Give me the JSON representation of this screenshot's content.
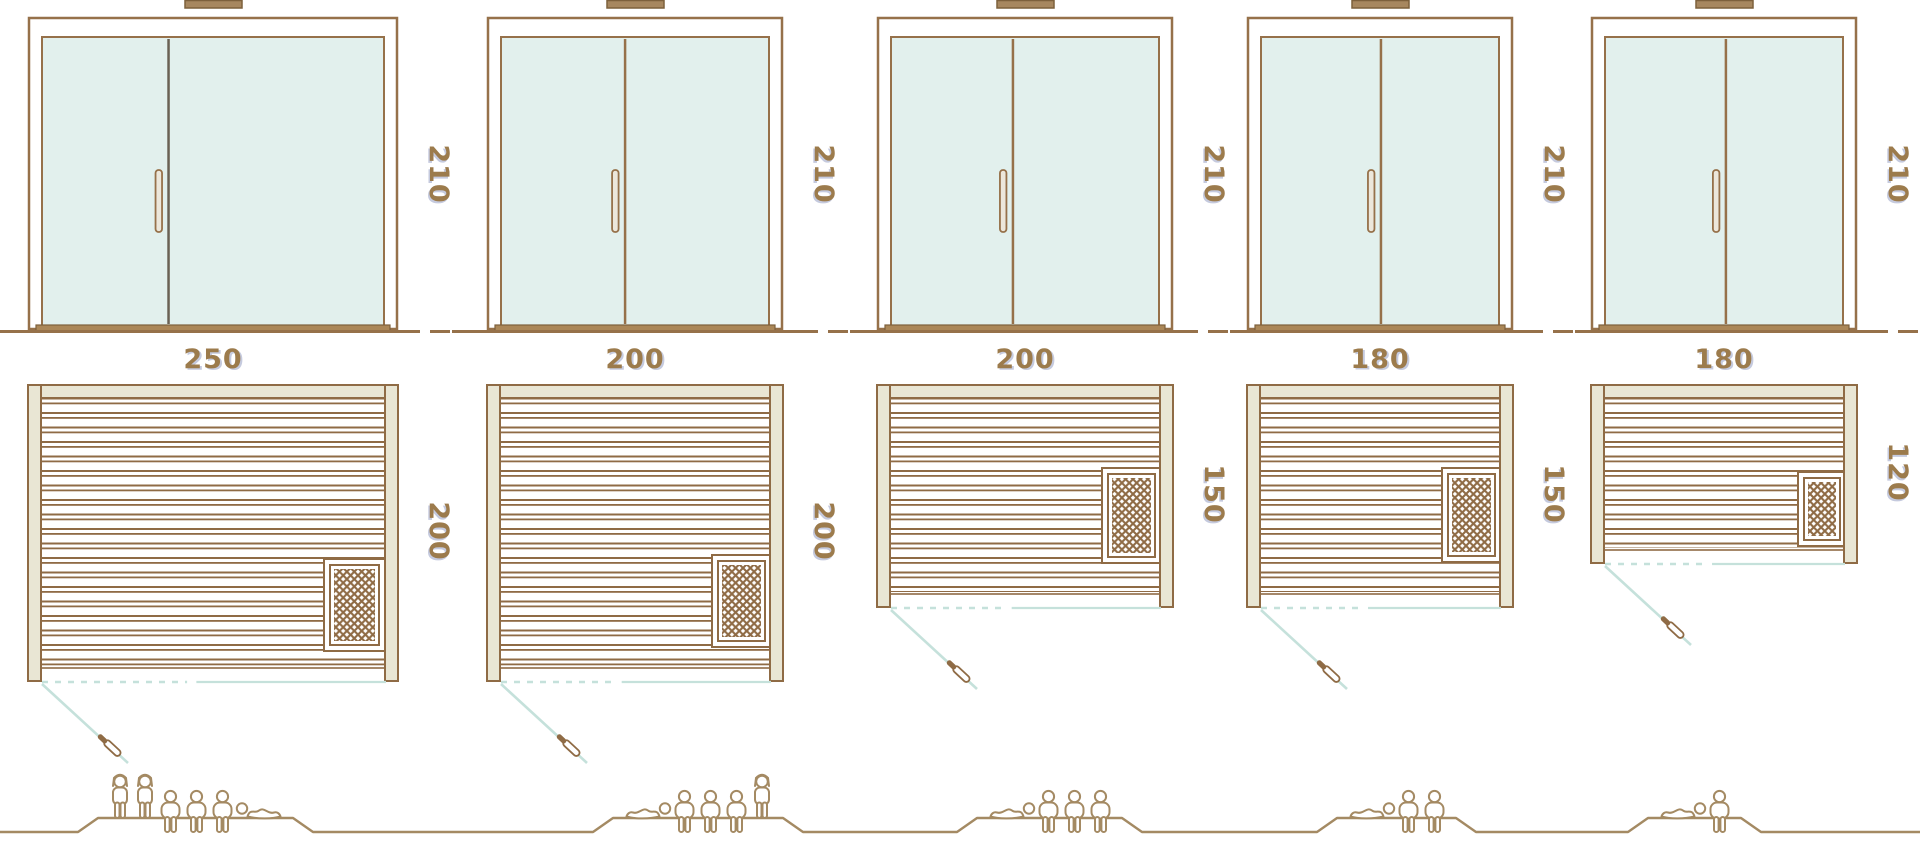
{
  "diagram_title": "sauna-size-comparison",
  "palette": {
    "line_brown": "#96714a",
    "plan_line_brown": "#8f6b45",
    "wall_beige": "#e9e6d4",
    "glass_mint": "#e2f0ed",
    "divider_dark": "#6a6154",
    "handle_fill": "#ece7db",
    "sill_tan": "#ab8758",
    "vent_tan": "#a7875f",
    "vent_edge": "#7d603c",
    "teal_door_swing": "#c5e1db",
    "figure_brown": "#a48a63",
    "label_brown": "#9c7b4c",
    "label_shadow_blue": "#7f8ab6",
    "heater_hatch_brown": "#8f6b45"
  },
  "saunas": [
    {
      "width_label": "250",
      "height_label": "210",
      "depth_label": "200",
      "width_cm": 250,
      "height_cm": 210,
      "depth_cm": 200,
      "door_split_fraction": 0.37,
      "divider_color": "#6a6154",
      "capacity": {
        "standing": 2,
        "seated": 3,
        "lying": 1
      },
      "figures": [
        "standing",
        "standing",
        "seated",
        "seated",
        "seated",
        "lying_right"
      ]
    },
    {
      "width_label": "200",
      "height_label": "210",
      "depth_label": "200",
      "width_cm": 200,
      "height_cm": 210,
      "depth_cm": 200,
      "door_split_fraction": 0.463,
      "divider_color": "#96714a",
      "capacity": {
        "standing": 1,
        "seated": 3,
        "lying": 1
      },
      "figures": [
        "lying_left",
        "seated",
        "seated",
        "seated",
        "standing"
      ]
    },
    {
      "width_label": "200",
      "height_label": "210",
      "depth_label": "150",
      "width_cm": 200,
      "height_cm": 210,
      "depth_cm": 150,
      "door_split_fraction": 0.455,
      "divider_color": "#96714a",
      "capacity": {
        "standing": 0,
        "seated": 3,
        "lying": 1
      },
      "figures": [
        "lying_left",
        "seated",
        "seated",
        "seated"
      ]
    },
    {
      "width_label": "180",
      "height_label": "210",
      "depth_label": "150",
      "width_cm": 180,
      "height_cm": 210,
      "depth_cm": 150,
      "door_split_fraction": 0.504,
      "divider_color": "#96714a",
      "capacity": {
        "standing": 0,
        "seated": 2,
        "lying": 1
      },
      "figures": [
        "lying_left",
        "seated",
        "seated"
      ]
    },
    {
      "width_label": "180",
      "height_label": "210",
      "depth_label": "120",
      "width_cm": 180,
      "height_cm": 210,
      "depth_cm": 120,
      "door_split_fraction": 0.508,
      "divider_color": "#96714a",
      "capacity": {
        "standing": 0,
        "seated": 1,
        "lying": 1
      },
      "figures": [
        "lying_left",
        "seated"
      ]
    }
  ]
}
